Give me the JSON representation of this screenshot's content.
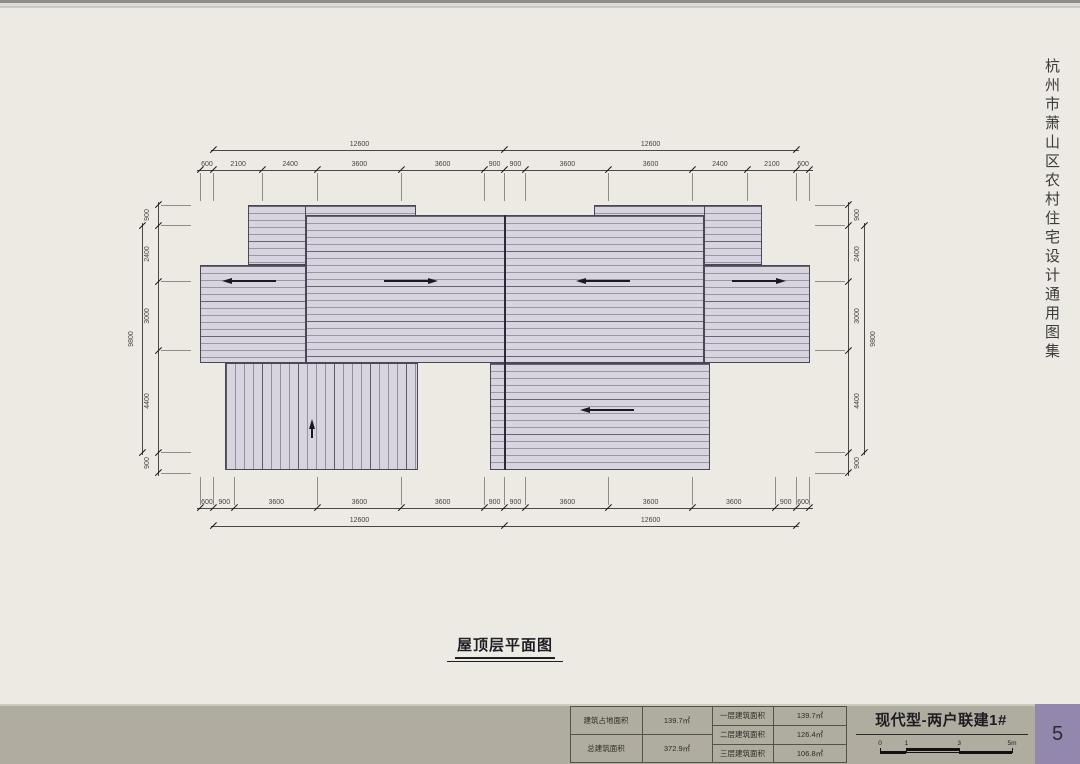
{
  "page": {
    "side_title": "杭州市萧山区农村住宅设计通用图集",
    "drawing_title": "屋顶层平面图",
    "page_number": "5"
  },
  "titleblock": {
    "project_title": "现代型-两户联建1#",
    "scalebar_labels": [
      "0",
      "1",
      "3",
      "5m"
    ],
    "stats_left": [
      {
        "label": "建筑占地面积",
        "value": "139.7㎡"
      },
      {
        "label": "总建筑面积",
        "value": "372.9㎡"
      }
    ],
    "stats_right": [
      {
        "label": "一层建筑面积",
        "value": "139.7㎡"
      },
      {
        "label": "二层建筑面积",
        "value": "126.4㎡"
      },
      {
        "label": "三层建筑面积",
        "value": "106.8㎡"
      }
    ]
  },
  "dimensions": {
    "top_segments": [
      600,
      2100,
      2400,
      3600,
      3600,
      900,
      900,
      3600,
      3600,
      2400,
      2100,
      600
    ],
    "top_overalls": [
      12600,
      12600
    ],
    "bottom_segments": [
      600,
      900,
      3600,
      3600,
      3600,
      900,
      900,
      3600,
      3600,
      3600,
      900,
      600
    ],
    "bottom_overalls": [
      12600,
      12600
    ],
    "left_segments": [
      900,
      2400,
      3000,
      4400,
      900
    ],
    "left_overall": 9800,
    "right_segments": [
      900,
      2400,
      3000,
      4400,
      900
    ],
    "right_overall": 9800
  },
  "colors": {
    "background": "#edeae3",
    "roof_fill": "#d8d4de",
    "roof_line": "#8f8a9b",
    "footer_band": "#b0ac9f",
    "page_accent": "#9487ad"
  }
}
